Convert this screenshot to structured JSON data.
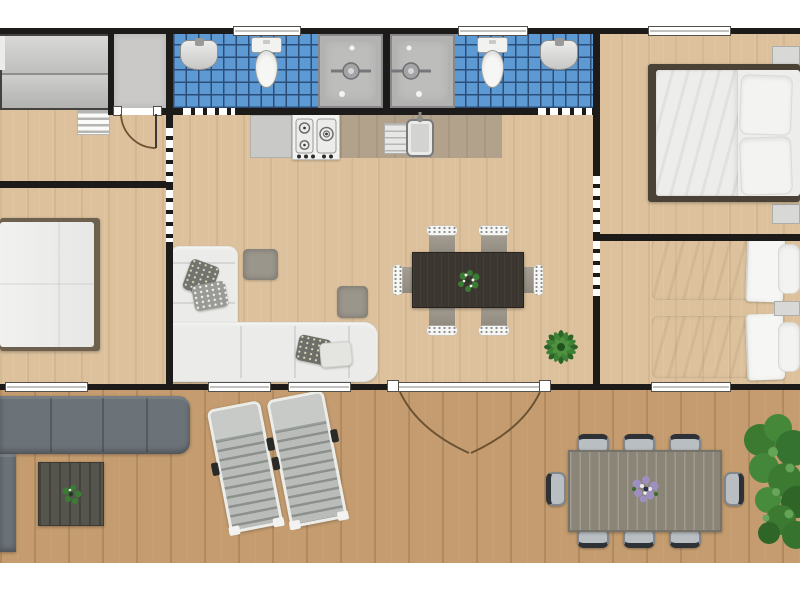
{
  "plan": {
    "kind": "holiday-home-floor-plan-top-view",
    "rooms": [
      {
        "name": "entry-hall",
        "items": [
          "sliding-door wardrobe",
          "open shelf unit"
        ]
      },
      {
        "name": "utility-room",
        "items": [
          "hinged door"
        ]
      },
      {
        "name": "bathroom-left",
        "items": [
          "washbasin",
          "toilet",
          "walk-in shower",
          "window"
        ]
      },
      {
        "name": "bathroom-right",
        "items": [
          "walk-in shower",
          "toilet",
          "washbasin",
          "window"
        ]
      },
      {
        "name": "bedroom-left",
        "items": [
          "double bed",
          "window"
        ]
      },
      {
        "name": "living-kitchen",
        "items": [
          "kitchen cabinet",
          "gas hob",
          "kitchen sink",
          "corner sofa",
          "4 cushions",
          "2 poufs",
          "dining table",
          "6 dining chairs",
          "potted palm",
          "2 windows",
          "double french door to deck"
        ]
      },
      {
        "name": "bedroom-top-right",
        "items": [
          "double bed",
          "2 pillows",
          "2 nightstands",
          "window"
        ]
      },
      {
        "name": "bedroom-mid-right",
        "items": [
          "2 single beds",
          "nightstand",
          "window"
        ]
      },
      {
        "name": "deck",
        "items": [
          "outdoor corner sofa",
          "coffee table with plant",
          "2 sun loungers",
          "outdoor dining table",
          "8 outdoor chairs",
          "flower centerpiece",
          "shrub"
        ]
      }
    ]
  },
  "colors": {
    "wall": "#1d1b19",
    "window_frame": "#55504a",
    "interior_floor": "#dcc19c",
    "deck_floor": "#c49c6f",
    "bathroom_tile": "#5d9ad4",
    "tile_grout": "#2b4d77",
    "utility_floor": "#cac9c7",
    "shower_tray": "#bdbdbb",
    "fixture_white": "#f6f6f4",
    "counter_gray": "#c9c9c7",
    "counter_wood": "#b2a28b",
    "sofa_white": "#ebebe9",
    "pouf_gray": "#9b968c",
    "dining_table_dark": "#3b362f",
    "chair_gray": "#8f897e",
    "bed_frame": "#6e604f",
    "bed_white": "#ededeb",
    "outdoor_sofa": "#6b7278",
    "coffee_table": "#56554d",
    "lounger_slat": "#b9bcb8",
    "outdoor_table": "#8d8b80",
    "outdoor_chair_seat": "#b8bec2",
    "outdoor_chair_frame": "#2e3236",
    "plant_green": "#3a7c33",
    "flower_purple": "#9d8fc0",
    "door_arc": "#6b5233"
  }
}
